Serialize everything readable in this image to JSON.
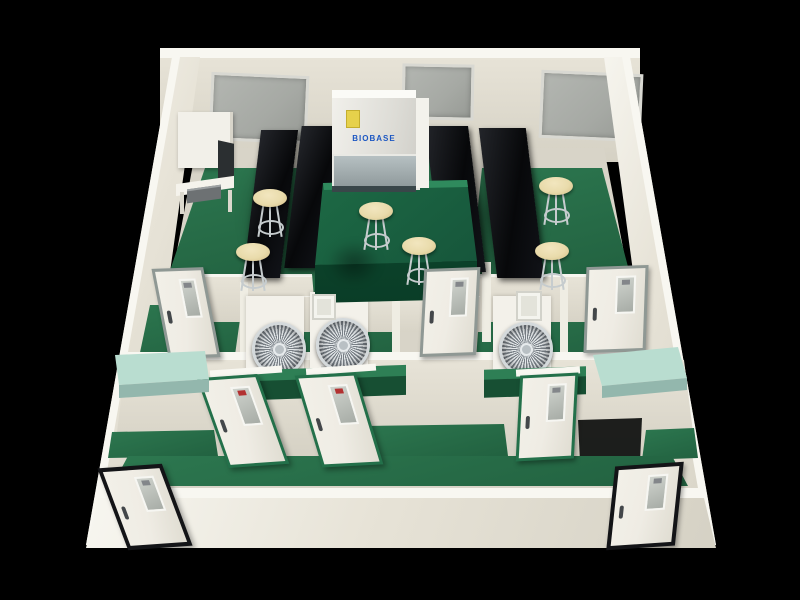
{
  "scene": {
    "description": "3D rendered cutaway view of a laboratory suite with green epoxy floors, cream walls, multiple rooms, lab benches and equipment",
    "view": "isometric cutaway from front-above",
    "background_color": "#000000"
  },
  "branding": {
    "cabinet_logo": "BIOBASE"
  },
  "inventory": {
    "windows": 3,
    "doors_total": 8,
    "doors_gray_frame": 3,
    "doors_green_frame": 3,
    "doors_black_frame": 2,
    "stools": 6,
    "fan_units": 3,
    "black_benches": 4,
    "green_island_bench": 1,
    "green_work_benches": 2,
    "wall_counters": 2,
    "wall_panels": 2,
    "biosafety_cabinet": 1,
    "workstation_desk": 1
  },
  "colors": {
    "background": "#000000",
    "wall-cream": "#e7e3d7",
    "wall-light": "#f8f7f1",
    "wall-shade": "#d5d1c4",
    "floor-green": "#2d7850",
    "floor-green-dark": "#21603f",
    "island-green-top": "#1d6a45",
    "island-green-front": "#0e4a2f",
    "bench-black": "#0d0e11",
    "counter-mint": "#b9ddd0",
    "counter-mint-front": "#93b7ad",
    "stool-seat": "#e9dbab",
    "metal-gray": "#c6ccce",
    "window-gray": "#a6a9a4",
    "door-face": "#efece4",
    "door-frame-gray": "#8f9894",
    "door-frame-green": "#23704a",
    "door-frame-black": "#131417",
    "glass-blue-gray": "#b6c0c2",
    "brand-blue": "#1c57c2",
    "sticker-yellow": "#e6d14b",
    "fan-blade-light": "#e4e8ea",
    "fan-blade-dark": "#798087"
  }
}
